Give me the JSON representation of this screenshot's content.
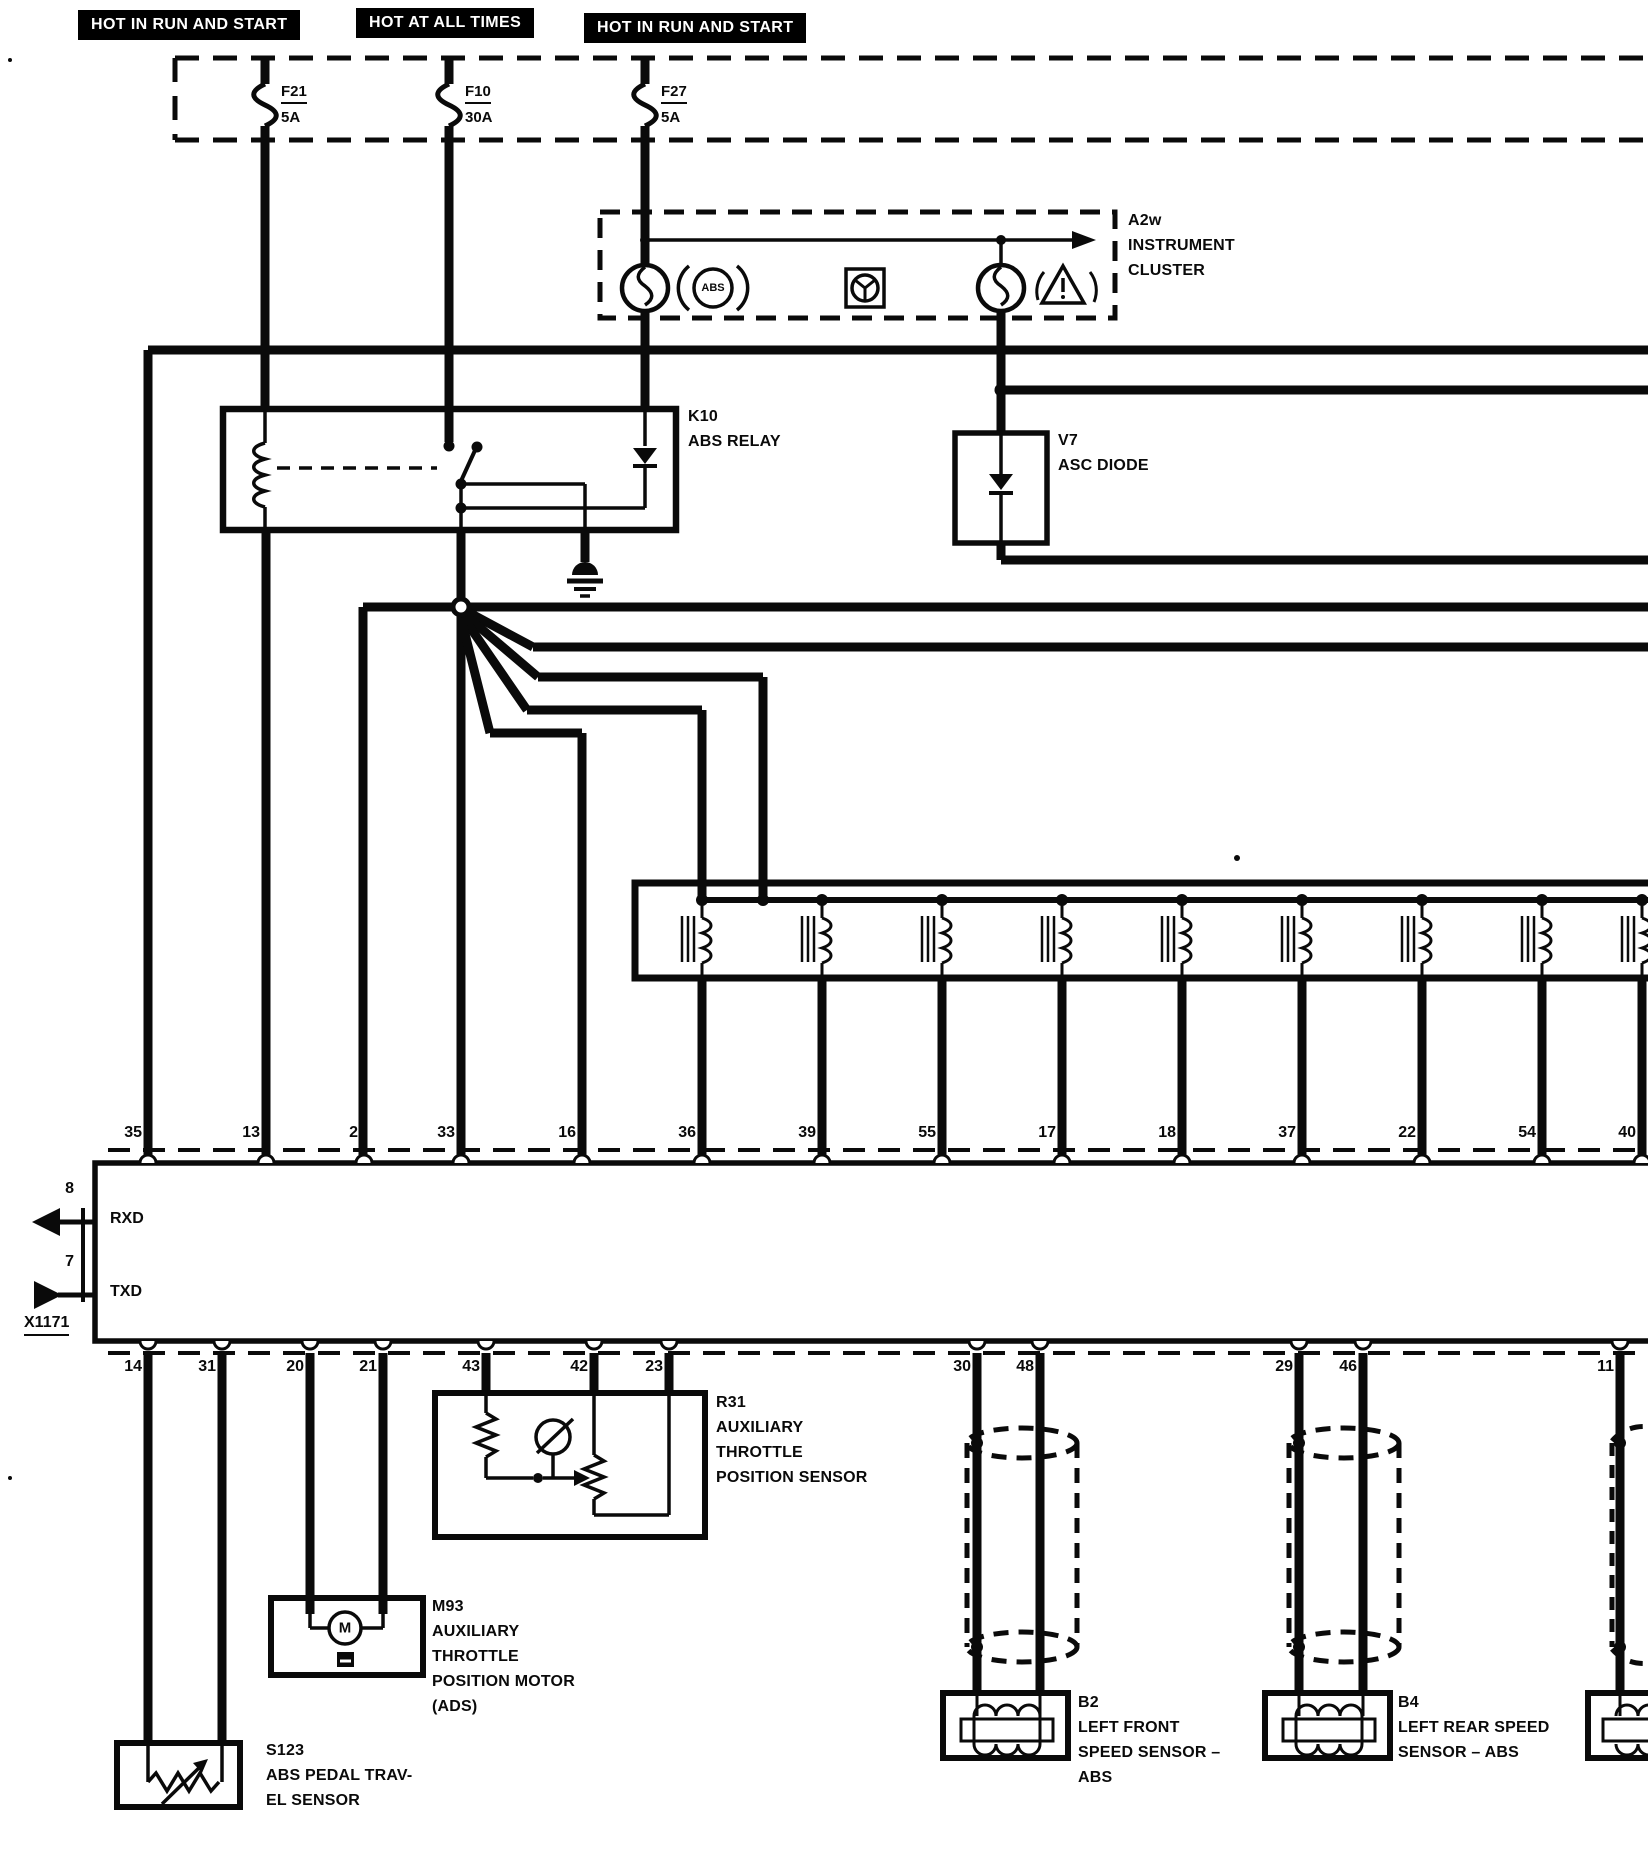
{
  "banners": [
    {
      "label": "HOT IN RUN AND START"
    },
    {
      "label": "HOT AT ALL TIMES"
    },
    {
      "label": "HOT IN RUN AND START"
    }
  ],
  "fuses": [
    {
      "id": "F21",
      "rating": "5A"
    },
    {
      "id": "F10",
      "rating": "30A"
    },
    {
      "id": "F27",
      "rating": "5A"
    }
  ],
  "cluster": {
    "lines": [
      "A2w",
      "INSTRUMENT",
      "CLUSTER"
    ],
    "abs_badge": "ABS"
  },
  "relay": {
    "lines": [
      "K10",
      "ABS RELAY"
    ]
  },
  "asc_diode": {
    "lines": [
      "V7",
      "ASC DIODE"
    ]
  },
  "module": {
    "top_pins": [
      "35",
      "13",
      "2",
      "33",
      "16",
      "36",
      "39",
      "55",
      "17",
      "18",
      "37",
      "22",
      "54",
      "40"
    ],
    "bottom_pins": [
      "14",
      "31",
      "20",
      "21",
      "43",
      "42",
      "23",
      "30",
      "48",
      "29",
      "46",
      "11"
    ],
    "left_ports": [
      {
        "pin": "8",
        "signal": "RXD"
      },
      {
        "pin": "7",
        "signal": "TXD"
      }
    ],
    "connector_label": "X1171"
  },
  "throttle_sensor": {
    "lines": [
      "R31",
      "AUXILIARY",
      "THROTTLE",
      "POSITION SENSOR"
    ]
  },
  "throttle_motor": {
    "lines": [
      "M93",
      "AUXILIARY",
      "THROTTLE",
      "POSITION MOTOR",
      "(ADS)"
    ],
    "motor_letter": "M"
  },
  "pedal_sensor": {
    "lines": [
      "S123",
      "ABS PEDAL TRAV-",
      "EL SENSOR"
    ]
  },
  "speed_sensor_lf": {
    "lines": [
      "B2",
      "LEFT FRONT",
      "SPEED SENSOR –",
      "ABS"
    ]
  },
  "speed_sensor_lr": {
    "lines": [
      "B4",
      "LEFT REAR SPEED",
      "SENSOR – ABS"
    ]
  },
  "colors": {
    "ink": "#0a0a0a",
    "paper": "#ffffff"
  }
}
